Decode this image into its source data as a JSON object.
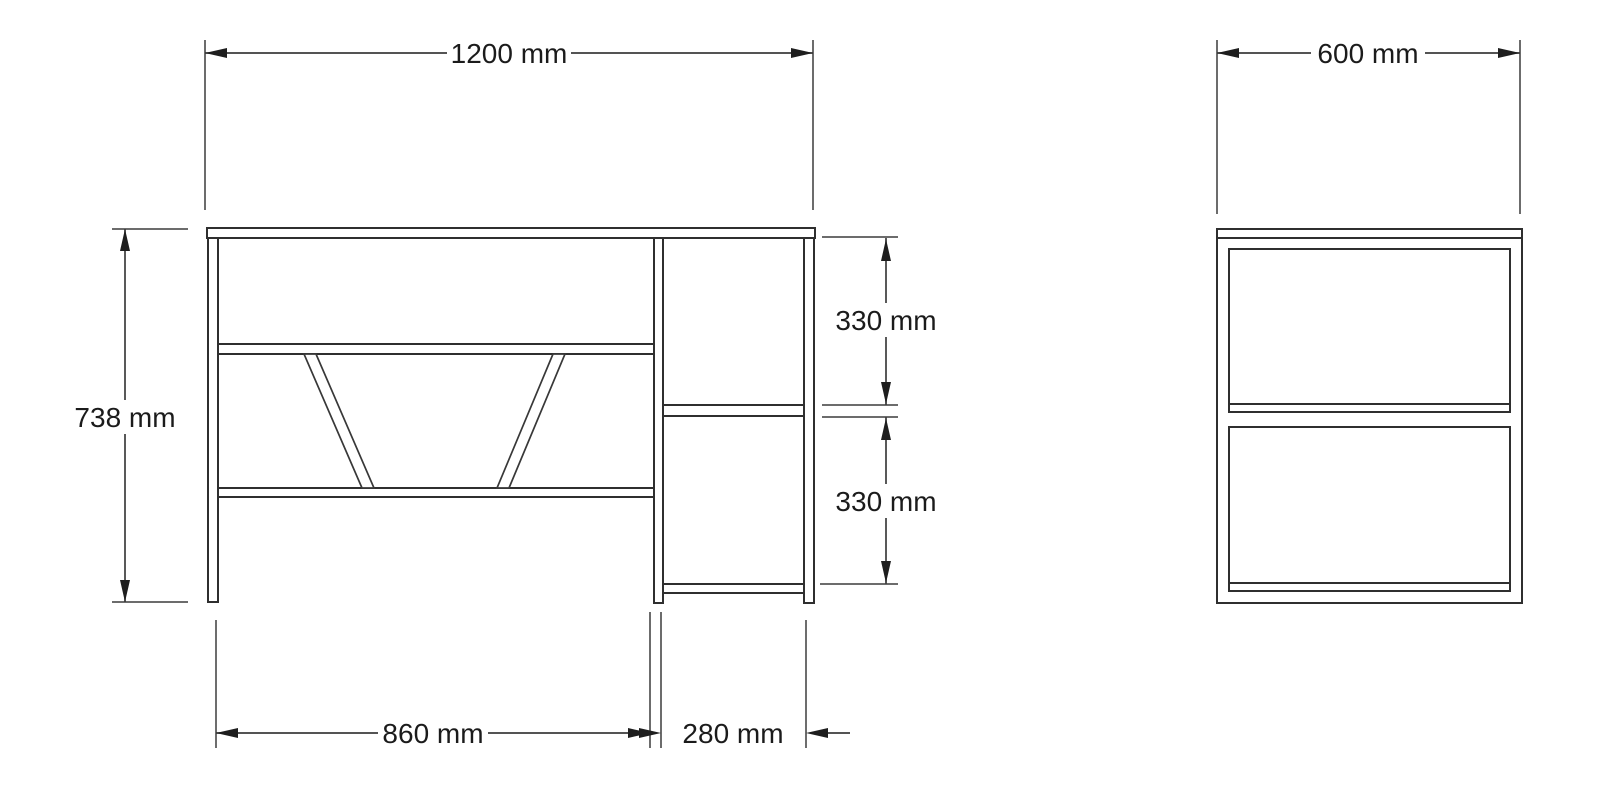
{
  "page": {
    "background": "#ffffff",
    "kind": "furniture technical dimension drawing"
  },
  "drawing": {
    "colors": {
      "line": "#2f2f2f",
      "dimension_line": "#3c3c3c",
      "text": "#1b1b1b",
      "background": "#ffffff"
    },
    "views": {
      "front": {
        "name": "front view of desk with side shelf unit",
        "dimensions": {
          "overall_width": {
            "label": "1200 mm",
            "value_mm": 1200
          },
          "overall_height": {
            "label": "738 mm",
            "value_mm": 738
          },
          "side_upper_opening": {
            "label": "330 mm",
            "value_mm": 330
          },
          "side_lower_opening": {
            "label": "330 mm",
            "value_mm": 330
          },
          "desk_section_width": {
            "label": "860 mm",
            "value_mm": 860
          },
          "shelf_section_width": {
            "label": "280 mm",
            "value_mm": 280
          }
        }
      },
      "side": {
        "name": "side view",
        "dimensions": {
          "depth": {
            "label": "600 mm",
            "value_mm": 600
          }
        }
      }
    }
  }
}
